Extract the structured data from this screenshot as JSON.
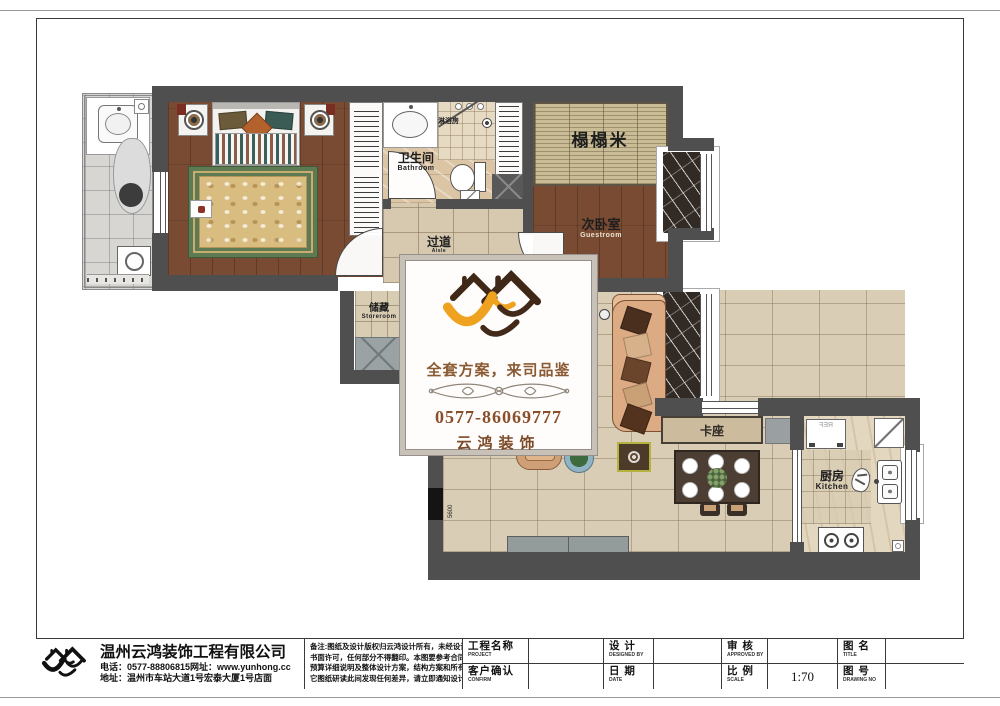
{
  "plan": {
    "rooms": [
      {
        "id": "bathroom",
        "label": "卫生间",
        "sublabel": "Bathroom"
      },
      {
        "id": "shower",
        "label": "淋浴房",
        "sublabel": ""
      },
      {
        "id": "tatami",
        "label": "榻榻米",
        "sublabel": ""
      },
      {
        "id": "guest_bedroom",
        "label": "次卧室",
        "sublabel": "Guestroom"
      },
      {
        "id": "aisle",
        "label": "过道",
        "sublabel": "Aisle"
      },
      {
        "id": "storage",
        "label": "储藏",
        "sublabel": "Storeroom"
      },
      {
        "id": "booth",
        "label": "卡座",
        "sublabel": ""
      },
      {
        "id": "kitchen",
        "label": "厨房",
        "sublabel": "Kitchen"
      }
    ],
    "fridge_label": "REF",
    "dimension_label": "5600"
  },
  "watermark": {
    "slogan": "全套方案，来司品鉴",
    "phone": "0577-86069777",
    "brand": "云鸿装饰"
  },
  "titleblock": {
    "company_name": "温州云鸿装饰工程有限公司",
    "company_tel": "电话：0577-88806815网址：www.yunhong.cc",
    "company_addr": "地址：温州市车站大道1号宏泰大厦1号店面",
    "notes": [
      "备注:图纸及设计版权归云鸿设计所有，未经设计师",
      "书面许可，任何部分不得翻印。本图要参考合同，",
      "预算详细说明及整体设计方案，结构方案和所有其",
      "它图纸研读此间发现任何差异，请立即通知设计师。"
    ],
    "fields": [
      {
        "zh": "工程名称",
        "en": "PROJECT",
        "value": ""
      },
      {
        "zh": "客户确认",
        "en": "CONFIRM",
        "value": ""
      },
      {
        "zh": "设 计",
        "en": "DESIGNED BY",
        "value": ""
      },
      {
        "zh": "日 期",
        "en": "DATE",
        "value": ""
      },
      {
        "zh": "审 核",
        "en": "APPROVED BY",
        "value": ""
      },
      {
        "zh": "比 例",
        "en": "SCALE",
        "value": "1:70"
      },
      {
        "zh": "图 名",
        "en": "TITLE",
        "value": ""
      },
      {
        "zh": "图 号",
        "en": "DRAWING NO",
        "value": ""
      }
    ]
  },
  "colors": {
    "wall": "#4f4f4f",
    "wood_floor": "#7a4b33",
    "logo_orange": "#efa21f",
    "logo_brown": "#3f2817",
    "watermark_text": "#8a5a33"
  }
}
